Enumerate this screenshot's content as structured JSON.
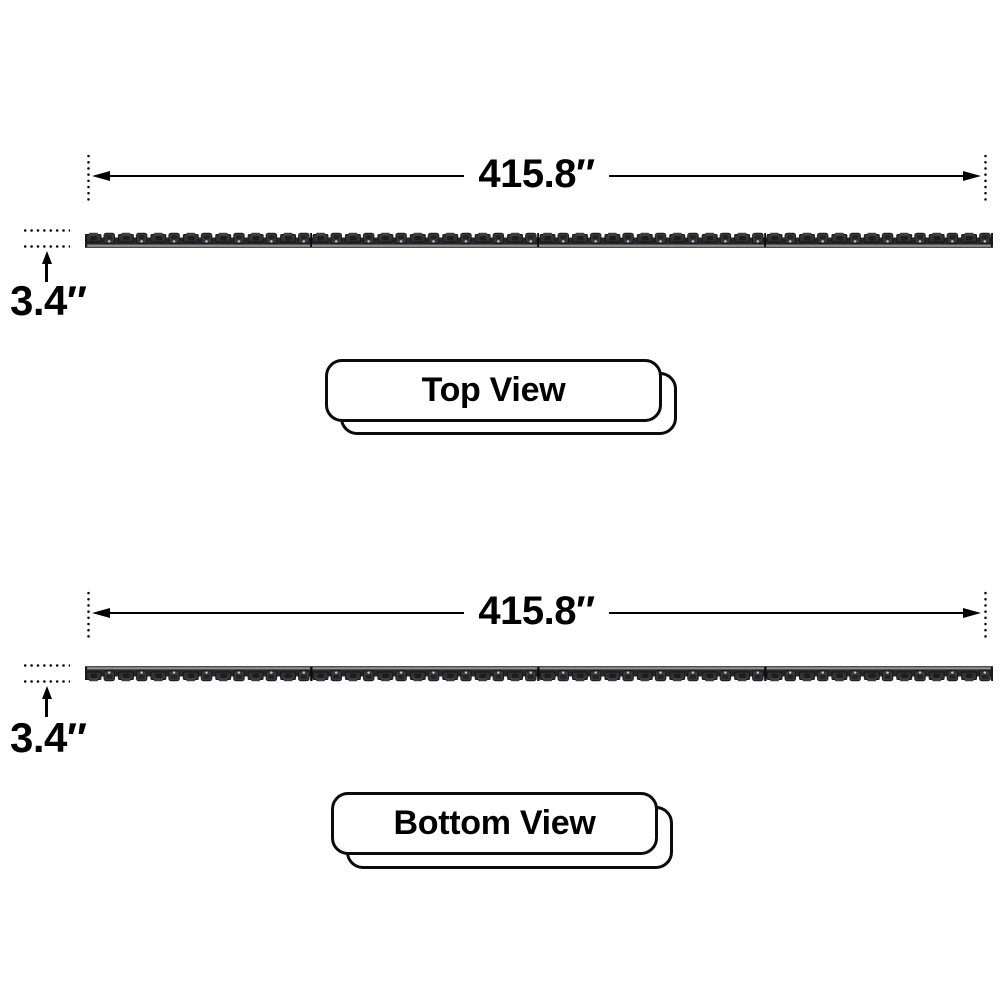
{
  "diagram": {
    "title": "product-dimension-diagram",
    "background_color": "#ffffff",
    "line_color": "#000000",
    "unit": "inches"
  },
  "views": [
    {
      "id": "top-view",
      "view_label": "Top View",
      "length_label": "415.8″",
      "height_label": "3.4″"
    },
    {
      "id": "bottom-view",
      "view_label": "Bottom View",
      "length_label": "415.8″",
      "height_label": "3.4″"
    }
  ],
  "icons": {
    "arrow-left": "left-pointing dimension arrowhead (CSS triangle)",
    "arrow-right": "right-pointing dimension arrowhead (CSS triangle)",
    "arrow-up": "up-pointing dimension arrowhead (CSS triangle)"
  },
  "bar_colors": {
    "body": "#28282c",
    "module_dark": "#1d1d21",
    "module_mid": "#313136",
    "module_light": "#3d3d43",
    "edge_highlight": "#929296",
    "screw_dot": "#cfc59c",
    "joint": "#0a0a0c"
  }
}
